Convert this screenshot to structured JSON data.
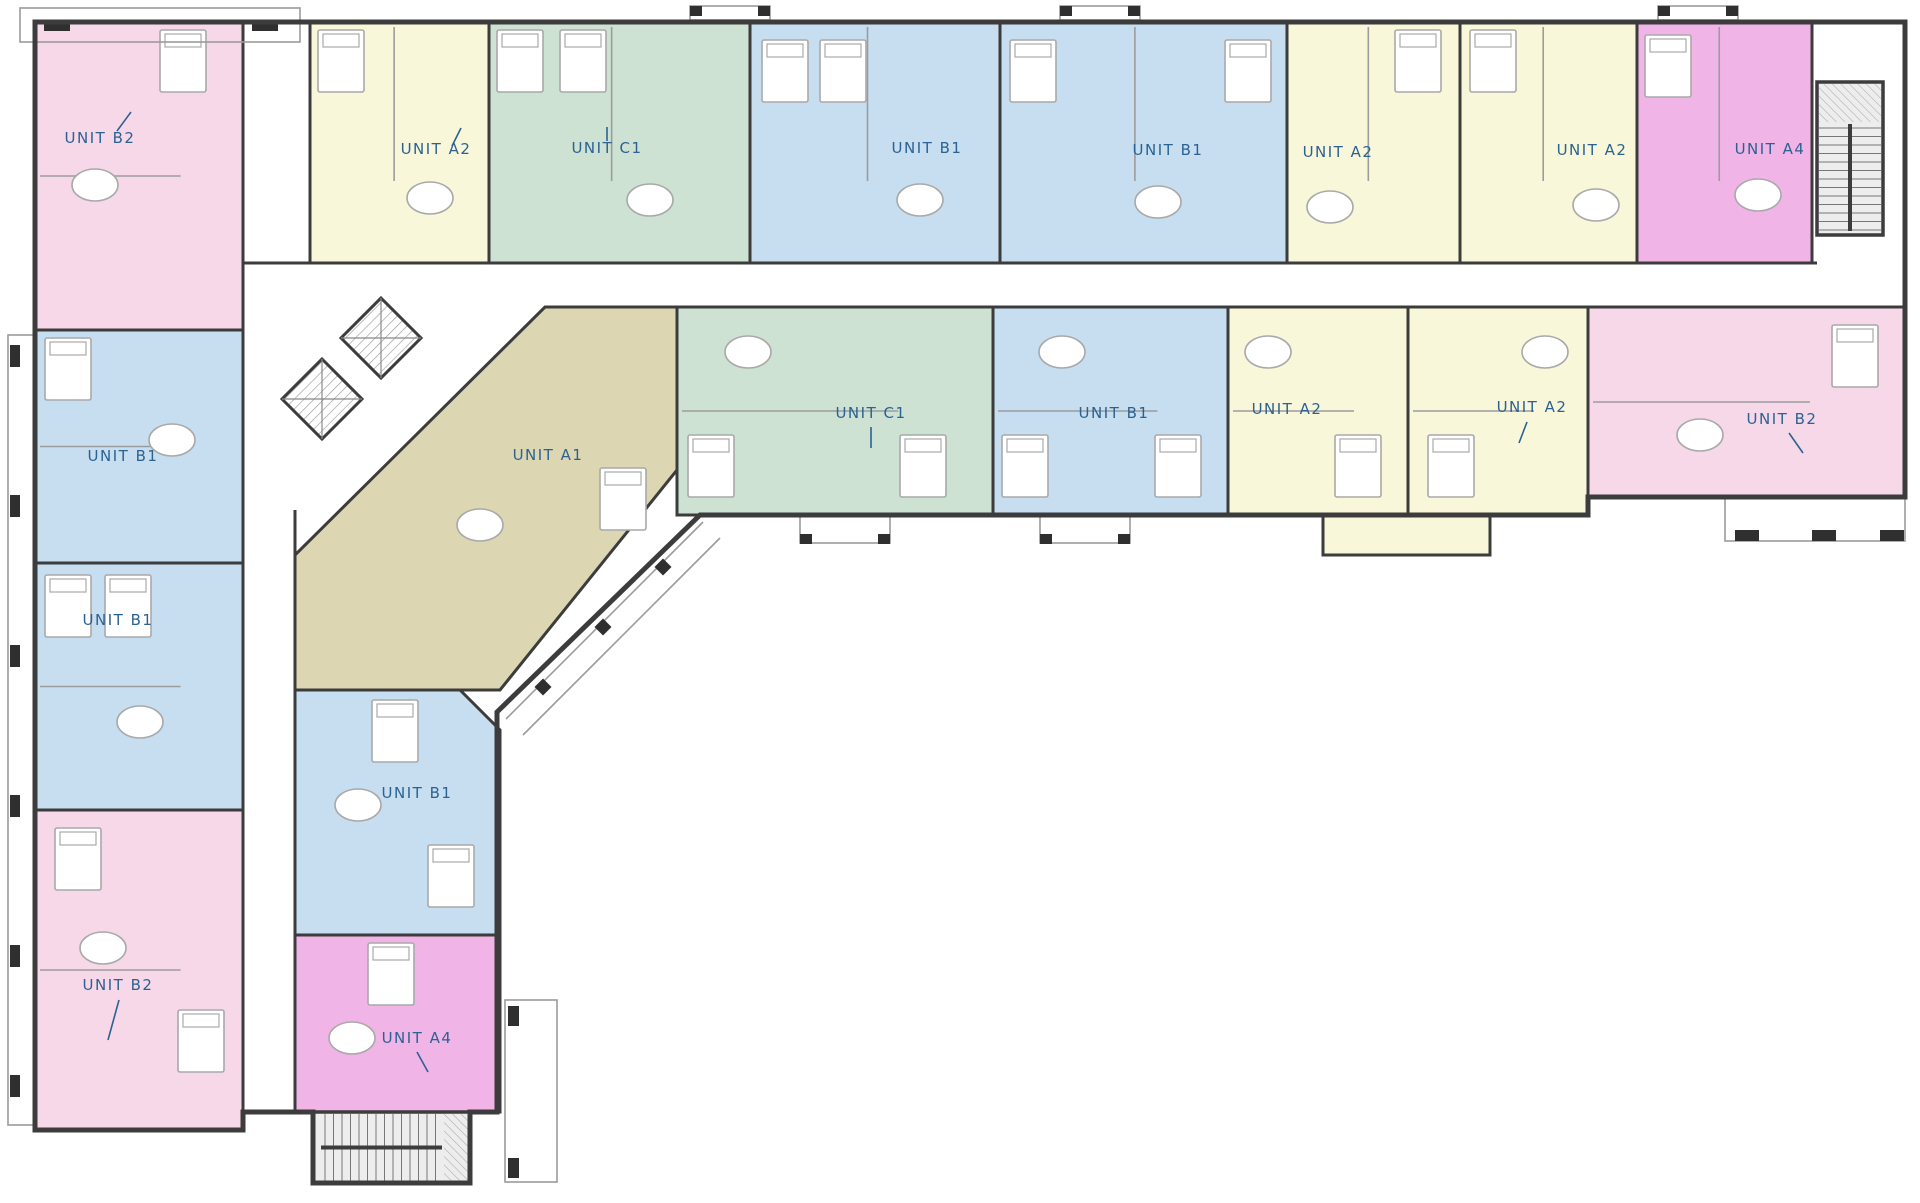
{
  "meta": {
    "title": "Apartment building floor plan",
    "canvas_w": 1920,
    "canvas_h": 1203
  },
  "palette": {
    "wall": "#3c3c3c",
    "label": "#2b6292",
    "porch": "#9b9b9b",
    "furniture": "#a9a9a9",
    "inner_wall": "#9c9c9c",
    "stair_fill": "#ededed",
    "pink": "#f6d8e9",
    "yellow": "#f9f7da",
    "green": "#cde2d2",
    "blue": "#c6def0",
    "tan": "#dcd7b2",
    "magenta": "#f1b4e7"
  },
  "units": [
    {
      "id": "b2-nw",
      "label": "UNIT B2",
      "color": "pink",
      "label_x": 100,
      "label_y": 143,
      "leader": [
        117,
        131,
        131,
        112
      ],
      "div": "h",
      "poly": [
        [
          35,
          22
        ],
        [
          243,
          22
        ],
        [
          243,
          330
        ],
        [
          35,
          330
        ]
      ],
      "beds": [
        [
          160,
          30
        ]
      ],
      "tables": [
        [
          95,
          185
        ]
      ]
    },
    {
      "id": "a2-n",
      "label": "UNIT A2",
      "color": "yellow",
      "label_x": 436,
      "label_y": 154,
      "leader": [
        452,
        146,
        461,
        128
      ],
      "div": "v",
      "poly": [
        [
          310,
          22
        ],
        [
          489,
          22
        ],
        [
          489,
          263
        ],
        [
          310,
          263
        ]
      ],
      "beds": [
        [
          318,
          30
        ]
      ],
      "tables": [
        [
          430,
          198
        ]
      ]
    },
    {
      "id": "c1-n",
      "label": "UNIT C1",
      "color": "green",
      "label_x": 607,
      "label_y": 153,
      "leader": [
        607,
        141,
        607,
        127
      ],
      "div": "v",
      "poly": [
        [
          489,
          22
        ],
        [
          750,
          22
        ],
        [
          750,
          263
        ],
        [
          489,
          263
        ]
      ],
      "beds": [
        [
          497,
          30
        ],
        [
          560,
          30
        ]
      ],
      "tables": [
        [
          650,
          200
        ]
      ]
    },
    {
      "id": "b1-n1",
      "label": "UNIT B1",
      "color": "blue",
      "label_x": 927,
      "label_y": 153,
      "leader": null,
      "div": "v",
      "poly": [
        [
          750,
          22
        ],
        [
          1000,
          22
        ],
        [
          1000,
          263
        ],
        [
          750,
          263
        ]
      ],
      "beds": [
        [
          762,
          40
        ],
        [
          820,
          40
        ]
      ],
      "tables": [
        [
          920,
          200
        ]
      ]
    },
    {
      "id": "b1-n2",
      "label": "UNIT B1",
      "color": "blue",
      "label_x": 1168,
      "label_y": 155,
      "leader": null,
      "div": "v",
      "poly": [
        [
          1000,
          22
        ],
        [
          1287,
          22
        ],
        [
          1287,
          263
        ],
        [
          1000,
          263
        ]
      ],
      "beds": [
        [
          1010,
          40
        ],
        [
          1225,
          40
        ]
      ],
      "tables": [
        [
          1158,
          202
        ]
      ]
    },
    {
      "id": "a2-n1",
      "label": "UNIT A2",
      "color": "yellow",
      "label_x": 1338,
      "label_y": 157,
      "leader": null,
      "div": "v",
      "poly": [
        [
          1287,
          22
        ],
        [
          1460,
          22
        ],
        [
          1460,
          263
        ],
        [
          1287,
          263
        ]
      ],
      "beds": [
        [
          1395,
          30
        ]
      ],
      "tables": [
        [
          1330,
          207
        ]
      ]
    },
    {
      "id": "a2-n2",
      "label": "UNIT A2",
      "color": "yellow",
      "label_x": 1592,
      "label_y": 155,
      "leader": null,
      "div": "v",
      "poly": [
        [
          1460,
          22
        ],
        [
          1637,
          22
        ],
        [
          1637,
          263
        ],
        [
          1460,
          263
        ]
      ],
      "beds": [
        [
          1470,
          30
        ]
      ],
      "tables": [
        [
          1596,
          205
        ]
      ]
    },
    {
      "id": "a4-n",
      "label": "UNIT A4",
      "color": "magenta",
      "label_x": 1770,
      "label_y": 154,
      "leader": null,
      "div": "v",
      "poly": [
        [
          1637,
          22
        ],
        [
          1812,
          22
        ],
        [
          1812,
          263
        ],
        [
          1637,
          263
        ]
      ],
      "beds": [
        [
          1645,
          35
        ]
      ],
      "tables": [
        [
          1758,
          195
        ]
      ]
    },
    {
      "id": "a1",
      "label": "UNIT A1",
      "color": "tan",
      "label_x": 548,
      "label_y": 460,
      "leader": null,
      "div": null,
      "poly": [
        [
          545,
          307
        ],
        [
          677,
          307
        ],
        [
          677,
          470
        ],
        [
          500,
          690
        ],
        [
          295,
          690
        ],
        [
          295,
          555
        ]
      ],
      "beds": [
        [
          600,
          468
        ]
      ],
      "tables": [
        [
          480,
          525
        ]
      ]
    },
    {
      "id": "c1-m",
      "label": "UNIT C1",
      "color": "green",
      "label_x": 871,
      "label_y": 418,
      "leader": [
        871,
        427,
        871,
        448
      ],
      "div": "h",
      "poly": [
        [
          677,
          307
        ],
        [
          993,
          307
        ],
        [
          993,
          515
        ],
        [
          677,
          515
        ]
      ],
      "beds": [
        [
          688,
          435
        ],
        [
          900,
          435
        ]
      ],
      "tables": [
        [
          748,
          352
        ]
      ]
    },
    {
      "id": "b1-m",
      "label": "UNIT B1",
      "color": "blue",
      "label_x": 1114,
      "label_y": 418,
      "leader": null,
      "div": "h",
      "poly": [
        [
          993,
          307
        ],
        [
          1228,
          307
        ],
        [
          1228,
          515
        ],
        [
          993,
          515
        ]
      ],
      "beds": [
        [
          1002,
          435
        ],
        [
          1155,
          435
        ]
      ],
      "tables": [
        [
          1062,
          352
        ]
      ]
    },
    {
      "id": "a2-m1",
      "label": "UNIT A2",
      "color": "yellow",
      "label_x": 1287,
      "label_y": 414,
      "leader": null,
      "div": "h",
      "poly": [
        [
          1228,
          307
        ],
        [
          1408,
          307
        ],
        [
          1408,
          515
        ],
        [
          1228,
          515
        ]
      ],
      "beds": [
        [
          1335,
          435
        ]
      ],
      "tables": [
        [
          1268,
          352
        ]
      ]
    },
    {
      "id": "a2-m2",
      "label": "UNIT A2",
      "color": "yellow",
      "label_x": 1532,
      "label_y": 412,
      "leader": [
        1527,
        422,
        1519,
        443
      ],
      "div": "h",
      "poly": [
        [
          1408,
          307
        ],
        [
          1588,
          307
        ],
        [
          1588,
          515
        ],
        [
          1408,
          515
        ]
      ],
      "beds": [
        [
          1428,
          435
        ]
      ],
      "tables": [
        [
          1545,
          352
        ]
      ]
    },
    {
      "id": "b2-m",
      "label": "UNIT B2",
      "color": "pink",
      "label_x": 1782,
      "label_y": 424,
      "leader": [
        1789,
        433,
        1803,
        453
      ],
      "div": "h",
      "poly": [
        [
          1588,
          307
        ],
        [
          1905,
          307
        ],
        [
          1905,
          497
        ],
        [
          1588,
          497
        ]
      ],
      "beds": [
        [
          1832,
          325
        ]
      ],
      "tables": [
        [
          1700,
          435
        ]
      ]
    },
    {
      "id": "b1-w1",
      "label": "UNIT B1",
      "color": "blue",
      "label_x": 123,
      "label_y": 461,
      "leader": null,
      "div": "h",
      "poly": [
        [
          35,
          330
        ],
        [
          243,
          330
        ],
        [
          243,
          563
        ],
        [
          35,
          563
        ]
      ],
      "beds": [
        [
          45,
          338
        ]
      ],
      "tables": [
        [
          172,
          440
        ]
      ]
    },
    {
      "id": "b1-w2",
      "label": "UNIT B1",
      "color": "blue",
      "label_x": 118,
      "label_y": 625,
      "leader": null,
      "div": "h",
      "poly": [
        [
          35,
          563
        ],
        [
          243,
          563
        ],
        [
          243,
          810
        ],
        [
          35,
          810
        ]
      ],
      "beds": [
        [
          45,
          575
        ],
        [
          105,
          575
        ]
      ],
      "tables": [
        [
          140,
          722
        ]
      ]
    },
    {
      "id": "b2-sw",
      "label": "UNIT B2",
      "color": "pink",
      "label_x": 118,
      "label_y": 990,
      "leader": [
        119,
        1000,
        108,
        1040
      ],
      "div": "h",
      "poly": [
        [
          35,
          810
        ],
        [
          243,
          810
        ],
        [
          243,
          1130
        ],
        [
          35,
          1130
        ]
      ],
      "beds": [
        [
          55,
          828
        ],
        [
          178,
          1010
        ]
      ],
      "tables": [
        [
          103,
          948
        ]
      ]
    },
    {
      "id": "b1-e",
      "label": "UNIT B1",
      "color": "blue",
      "label_x": 417,
      "label_y": 798,
      "leader": null,
      "div": null,
      "poly": [
        [
          295,
          690
        ],
        [
          460,
          690
        ],
        [
          500,
          730
        ],
        [
          500,
          935
        ],
        [
          295,
          935
        ]
      ],
      "beds": [
        [
          372,
          700
        ],
        [
          428,
          845
        ]
      ],
      "tables": [
        [
          358,
          805
        ]
      ]
    },
    {
      "id": "a4-e",
      "label": "UNIT A4",
      "color": "magenta",
      "label_x": 417,
      "label_y": 1043,
      "leader": [
        417,
        1052,
        428,
        1072
      ],
      "div": null,
      "poly": [
        [
          295,
          935
        ],
        [
          500,
          935
        ],
        [
          500,
          1112
        ],
        [
          295,
          1112
        ]
      ],
      "beds": [
        [
          368,
          943
        ]
      ],
      "tables": [
        [
          352,
          1038
        ]
      ]
    }
  ],
  "extras": [
    {
      "name": "a2-pair-south-bay",
      "color": "yellow",
      "poly": [
        [
          1323,
          515
        ],
        [
          1490,
          515
        ],
        [
          1490,
          555
        ],
        [
          1323,
          555
        ]
      ]
    }
  ],
  "corridor_walls": [
    [
      243,
      263,
      1817,
      263
    ],
    [
      545,
      307,
      1905,
      307
    ],
    [
      243,
      263,
      243,
      335
    ],
    [
      243,
      490,
      243,
      1112
    ],
    [
      295,
      510,
      295,
      1112
    ],
    [
      1812,
      235,
      1812,
      263
    ]
  ],
  "stairs": [
    {
      "id": "stair-ne",
      "x": 1817,
      "y": 82,
      "w": 66,
      "h": 153,
      "dir": "v"
    },
    {
      "id": "stair-s",
      "x": 313,
      "y": 1112,
      "w": 157,
      "h": 71,
      "dir": "h"
    }
  ],
  "elevators": [
    {
      "cx": 381,
      "cy": 338,
      "r": 40
    },
    {
      "cx": 322,
      "cy": 399,
      "r": 40
    }
  ],
  "porches": {
    "rects": [
      [
        20,
        8,
        280,
        34
      ],
      [
        8,
        335,
        26,
        790
      ],
      [
        690,
        6,
        80,
        14
      ],
      [
        1060,
        6,
        80,
        14
      ],
      [
        1658,
        6,
        80,
        14
      ],
      [
        1725,
        497,
        180,
        44
      ],
      [
        505,
        1000,
        52,
        182
      ],
      [
        800,
        515,
        90,
        28
      ],
      [
        1040,
        515,
        90,
        28
      ]
    ],
    "posts": [
      [
        44,
        20,
        26,
        11
      ],
      [
        252,
        20,
        26,
        11
      ],
      [
        10,
        345,
        10,
        22
      ],
      [
        10,
        495,
        10,
        22
      ],
      [
        10,
        645,
        10,
        22
      ],
      [
        10,
        795,
        10,
        22
      ],
      [
        10,
        945,
        10,
        22
      ],
      [
        10,
        1075,
        10,
        22
      ],
      [
        690,
        6,
        12,
        10
      ],
      [
        758,
        6,
        12,
        10
      ],
      [
        1060,
        6,
        12,
        10
      ],
      [
        1128,
        6,
        12,
        10
      ],
      [
        1658,
        6,
        12,
        10
      ],
      [
        1726,
        6,
        12,
        10
      ],
      [
        1735,
        530,
        24,
        11
      ],
      [
        1812,
        530,
        24,
        11
      ],
      [
        1880,
        530,
        24,
        11
      ],
      [
        508,
        1006,
        11,
        20
      ],
      [
        508,
        1158,
        11,
        20
      ],
      [
        800,
        534,
        12,
        10
      ],
      [
        878,
        534,
        12,
        10
      ],
      [
        1040,
        534,
        12,
        10
      ],
      [
        1118,
        534,
        12,
        10
      ]
    ],
    "diag_lines": [
      [
        703,
        522,
        506,
        719
      ],
      [
        720,
        538,
        523,
        735
      ]
    ],
    "diag_posts": [
      [
        663,
        567
      ],
      [
        603,
        627
      ],
      [
        543,
        687
      ]
    ]
  },
  "perimeter": "M35,22 H1905 V497 H1588 V515 H700 L497,712 V1112 H470 V1183 H313 V1112 H243 V1130 H35 Z"
}
